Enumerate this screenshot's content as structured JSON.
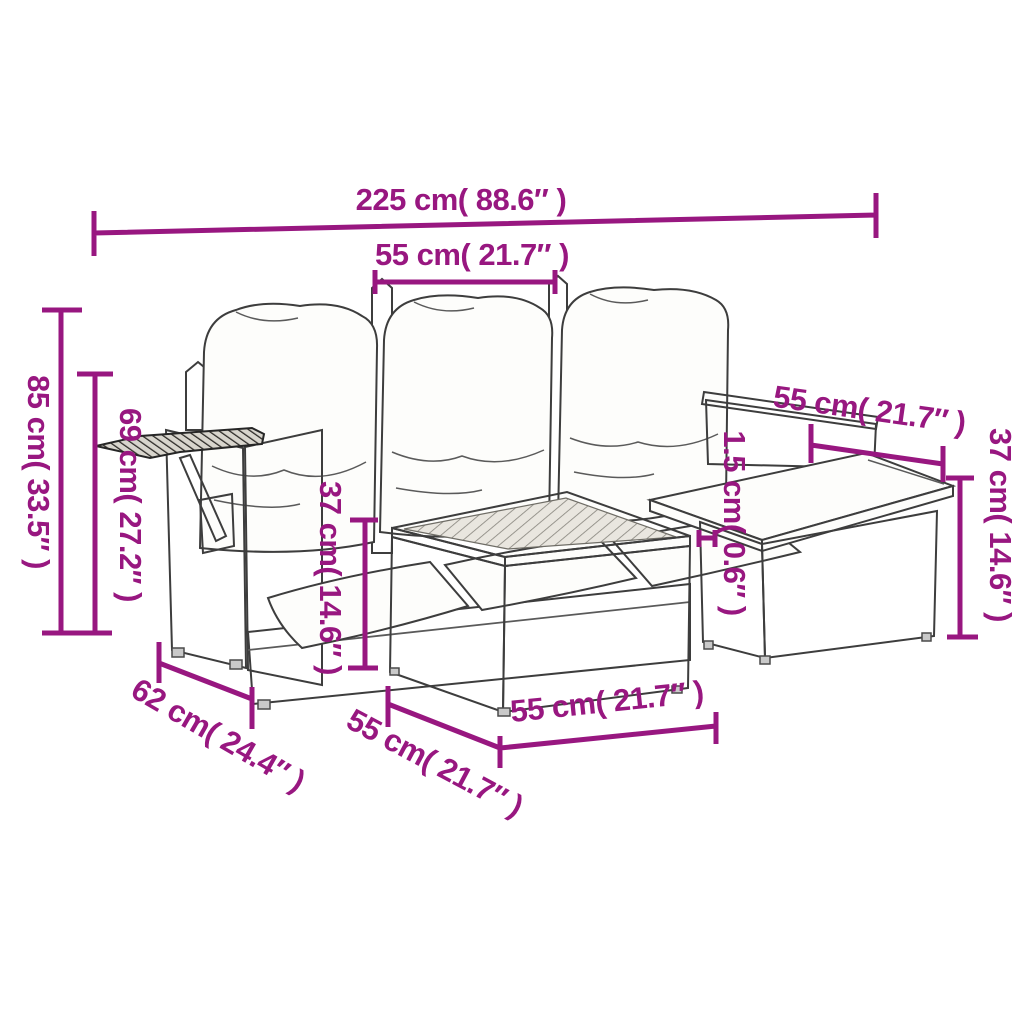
{
  "figure_caption": "Garden furniture set dimension diagram",
  "colors": {
    "dimension_accent": "#981780",
    "line_art": "#3d3d3d",
    "background": "#ffffff"
  },
  "dims": {
    "overall_width": {
      "label": "225 cm( 88.6″ )",
      "cm": "225",
      "inches": "88.6"
    },
    "seat_width_top": {
      "label": "55 cm( 21.7″ )",
      "cm": "55",
      "inches": "21.7"
    },
    "overall_height": {
      "label": "85 cm( 33.5″ )",
      "cm": "85",
      "inches": "33.5"
    },
    "armrest_height": {
      "label": "69 cm( 27.2″ )",
      "cm": "69",
      "inches": "27.2"
    },
    "seat_height": {
      "label": "37 cm( 14.6″ )",
      "cm": "37",
      "inches": "14.6"
    },
    "backrest_width": {
      "label": "55 cm( 21.7″ )",
      "cm": "55",
      "inches": "21.7"
    },
    "board_thickness": {
      "label": "1.5 cm( 0.6″ )",
      "cm": "1.5",
      "inches": "0.6"
    },
    "ottoman_height": {
      "label": "37 cm( 14.6″ )",
      "cm": "37",
      "inches": "14.6"
    },
    "seat_depth": {
      "label": "62 cm( 24.4″ )",
      "cm": "62",
      "inches": "24.4"
    },
    "table_depth": {
      "label": "55 cm( 21.7″ )",
      "cm": "55",
      "inches": "21.7"
    },
    "table_width": {
      "label": "55 cm( 21.7″ )",
      "cm": "55",
      "inches": "21.7"
    }
  }
}
